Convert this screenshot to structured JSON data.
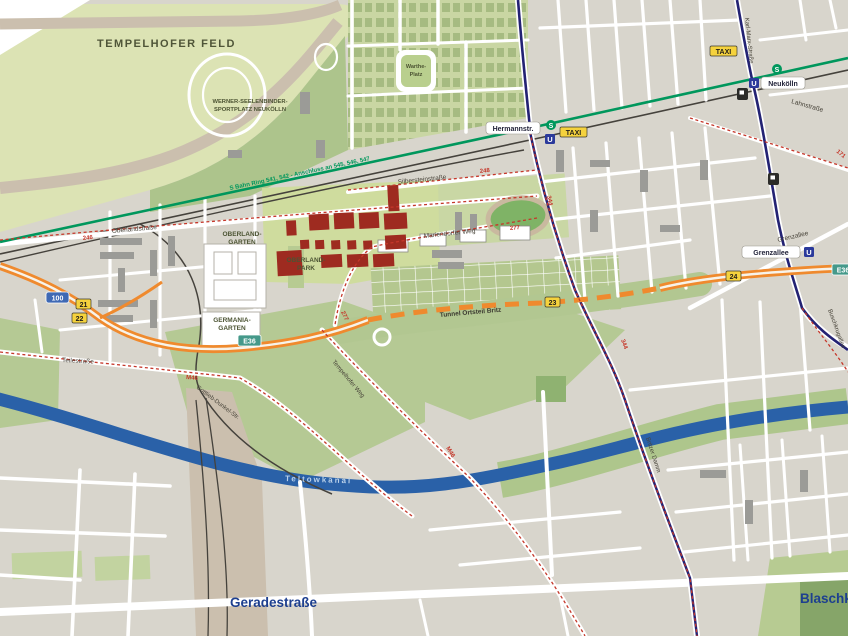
{
  "areas": {
    "tempelhofer_feld": "TEMPELHOFER FELD",
    "sportplatz_line1": "WERNER-SEELENBINDER-",
    "sportplatz_line2": "SPORTPLATZ NEUKÖLLN",
    "warthe_platz_line1": "Warthe-",
    "warthe_platz_line2": "Platz",
    "oberland_garten_line1": "OBERLAND-",
    "oberland_garten_line2": "GARTEN",
    "oberland_park_line1": "OBERLAND-",
    "oberland_park_line2": "PARK",
    "germania_garten_line1": "GERMANIA-",
    "germania_garten_line2": "GARTEN"
  },
  "streets": {
    "silbersteinstrasse": "Silbersteinstraße",
    "oberlandstrasse": "Oberlandstraße",
    "mariendorfer_weg": "Mariendorfer Weg",
    "lahnstrasse": "Lahnstraße",
    "karl_marx_strasse": "Karl-Marx-Straße",
    "grenzallee": "Grenzallee",
    "teilestrasse": "Teilestraße",
    "gottlieb_dunkel_str": "Gottlieb-Dunkel-Str.",
    "tempelhofer_weg": "Tempelhofer Weg",
    "britzer_damm": "Britzer Damm",
    "buschkrugallee": "Buschkrugallee",
    "geradestrasse": "Geradestraße",
    "blaschkoallee": "Blaschko",
    "tunnel_label": "Tunnel Ortsteil Britz"
  },
  "water": {
    "teltowkanal": "Teltowkanal"
  },
  "transit": {
    "sbahn_ring_label": "S Bahn Ring 541, 542   -   Anschluss an 545, 546, 547",
    "station_hermannstr": "Hermannstr.",
    "station_neukoelln": "Neukölln",
    "station_grenzallee": "Grenzallee",
    "s_symbol": "S",
    "u_symbol": "U",
    "taxi": "TAXI"
  },
  "routes": {
    "r246": "246",
    "r248": "248",
    "r277": "277",
    "r344": "344",
    "m46": "M46",
    "r171": "171"
  },
  "motorway": {
    "a100": "100",
    "exit21": "21",
    "exit22": "22",
    "exit23": "23",
    "exit24": "24",
    "e36": "E36"
  },
  "colors": {
    "background": "#d8d5cc",
    "field_green": "#dce3b4",
    "park_green": "#b5c994",
    "garden_green": "#c9d6a3",
    "canal_blue": "#2a61a8",
    "sbahn_green": "#00975c",
    "ubahn_navy": "#232273",
    "motorway_orange": "#ef8a2e",
    "route_red": "#c5372a",
    "badge_yellow": "#f5d23d",
    "badge_blue": "#3f69b4",
    "e36_teal": "#45998a",
    "building_red": "#9e2b20",
    "rail_black": "#45423c",
    "yard_tan": "#cbbfae"
  }
}
